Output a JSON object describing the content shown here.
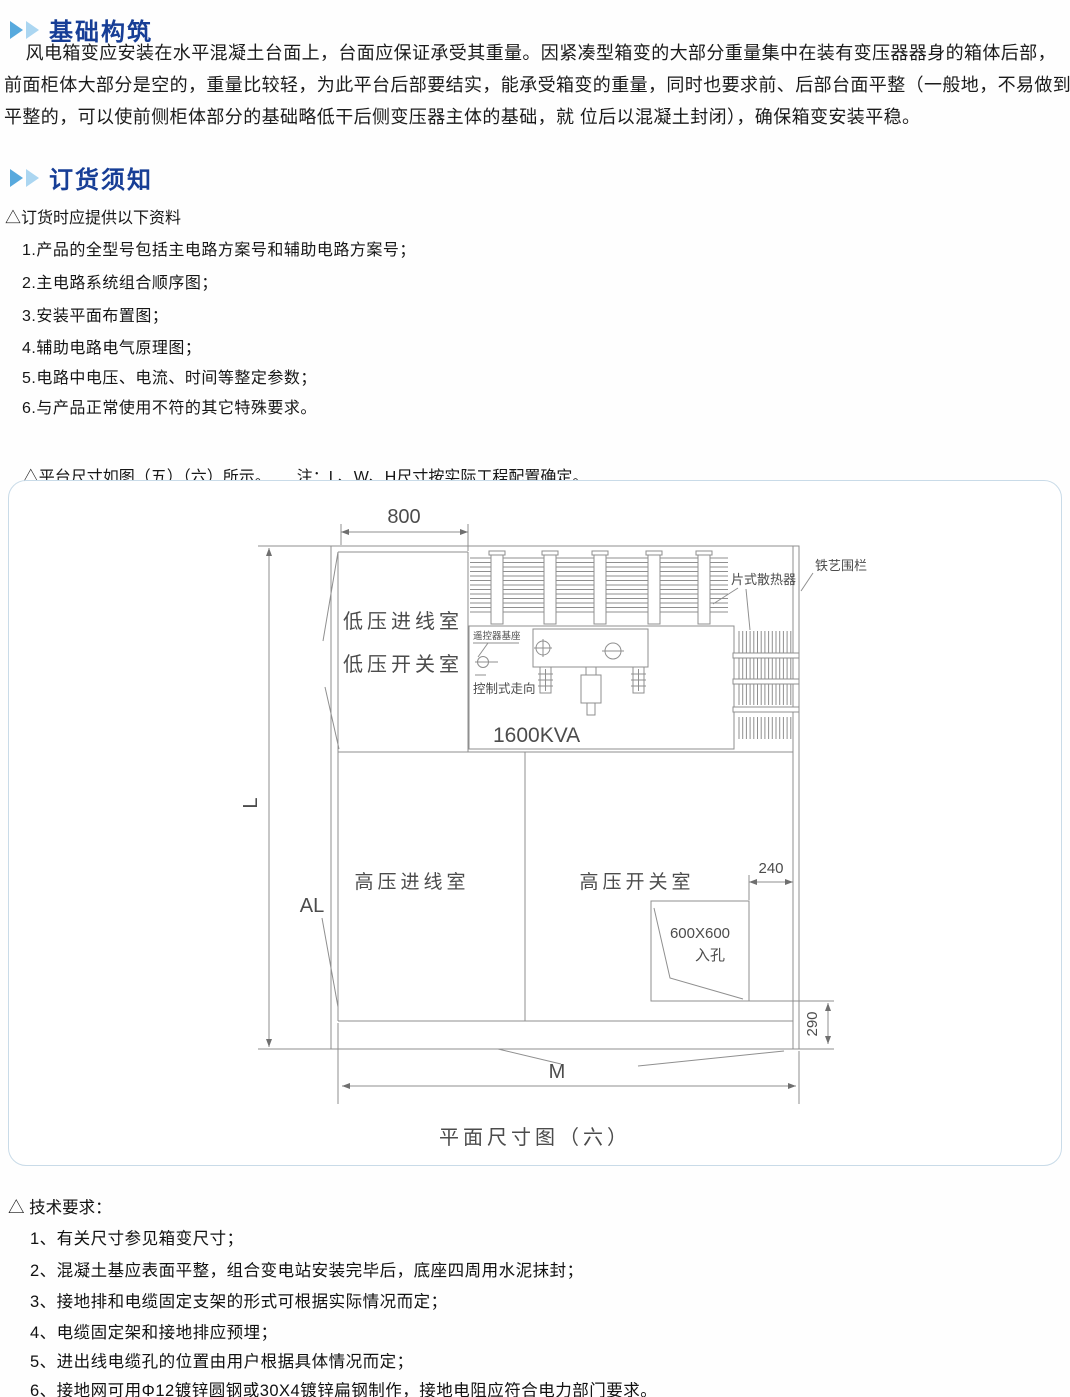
{
  "foundation": {
    "title": "基础构筑",
    "lines": [
      "    风电箱变应安装在水平混凝土台面上，台面应保证承受其重量。因紧凑型箱变的大部分重量集中在装有变压器器身的箱体后部，",
      "前面柜体大部分是空的，重量比较轻，为此平台后部要结实，能承受箱变的重量，同时也要求前、后部台面平整（一般地，不易做到",
      "平整的，可以使前侧柜体部分的基础略低干后侧变压器主体的基础，就 位后以混凝土封闭），确保箱变安装平稳。"
    ]
  },
  "ordering": {
    "title": "订货须知",
    "note": "△订货时应提供以下资料",
    "items": [
      "1.产品的全型号包括主电路方案号和辅助电路方案号；",
      "2.主电路系统组合顺序图；",
      "3.安装平面布置图；",
      "4.辅助电路电气原理图；",
      "5.电路中电压、电流、时间等整定参数；",
      "6.与产品正常使用不符的其它特殊要求。"
    ],
    "platform_note": "△平台尺寸如图（五）（六）所示。",
    "platform_note2": "注：L、W、H尺寸按实际工程配置确定。"
  },
  "diagram": {
    "caption": "平面尺寸图（六）",
    "labels": {
      "dim_800": "800",
      "dim_L": "L",
      "dim_AL": "AL",
      "room_lv_incoming": "低压进线室",
      "room_lv_switch": "低压开关室",
      "radiator": "片式散热器",
      "fence": "铁艺围栏",
      "remote_base": "遥控器基座",
      "control_direction": "控制式走向",
      "transformer_rating": "1600KVA",
      "room_hv_incoming": "高压进线室",
      "room_hv_switch": "高压开关室",
      "dim_240": "240",
      "manhole_size": "600X600",
      "manhole": "入孔",
      "dim_290": "290",
      "dim_M": "M"
    }
  },
  "tech": {
    "title": "△ 技术要求：",
    "items": [
      "1、有关尺寸参见箱变尺寸；",
      "2、混凝土基应表面平整，组合变电站安装完毕后，底座四周用水泥抹封；",
      "3、接地排和电缆固定支架的形式可根据实际情况而定；",
      "4、电缆固定架和接地排应预埋；",
      "5、进出线电缆孔的位置由用户根据具体情况而定；",
      "6、接地网可用Φ12镀锌圆钢或30X4镀锌扁钢制作，接地电阻应符合电力部门要求。"
    ]
  },
  "colors": {
    "title_blue": "#173e96",
    "arrow_dark": "#57a9dd",
    "arrow_light": "#abd6f1",
    "panel_border": "#c9dbe8",
    "line_gray": "#8f8f8f"
  }
}
